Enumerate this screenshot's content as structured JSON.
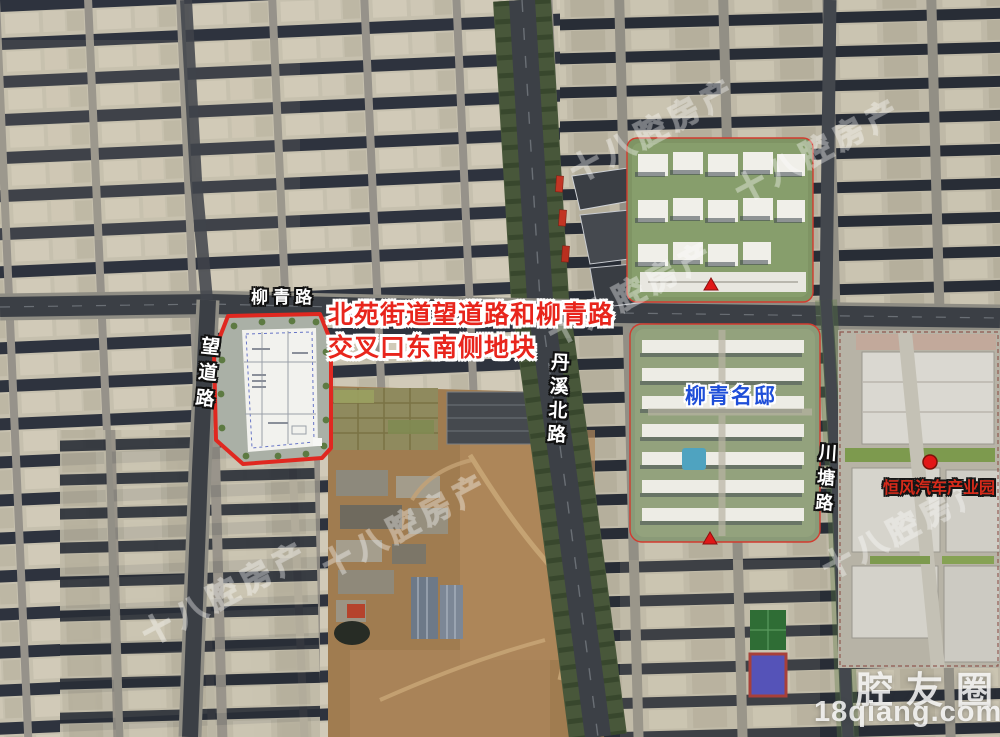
{
  "map": {
    "annotation": {
      "line1": "北苑街道望道路和柳青路",
      "line2": "交叉口东南侧地块"
    },
    "roads": {
      "liuqing": "柳青路",
      "wangdao": "望道路",
      "danxi_north": "丹溪北路",
      "chuantang": "川塘路"
    },
    "places": {
      "residential": "柳青名邸",
      "industrial": "恒风汽车产业园"
    },
    "watermark": {
      "diagonal": "十八腔房产",
      "brand": "腔友圈",
      "url": "18qiang.com"
    },
    "markers": {
      "plot_outline": "red-plot-boundary",
      "industrial_dot": "red-dot-marker",
      "road_triangles": "red-triangle-marker"
    },
    "colors": {
      "annotation_red": "#e8251c",
      "residential_blue": "#1e4ed8",
      "industrial_red": "#d62a1a",
      "plot_outline_red": "#e02820",
      "complex_outline_red": "#d23b2f"
    }
  }
}
